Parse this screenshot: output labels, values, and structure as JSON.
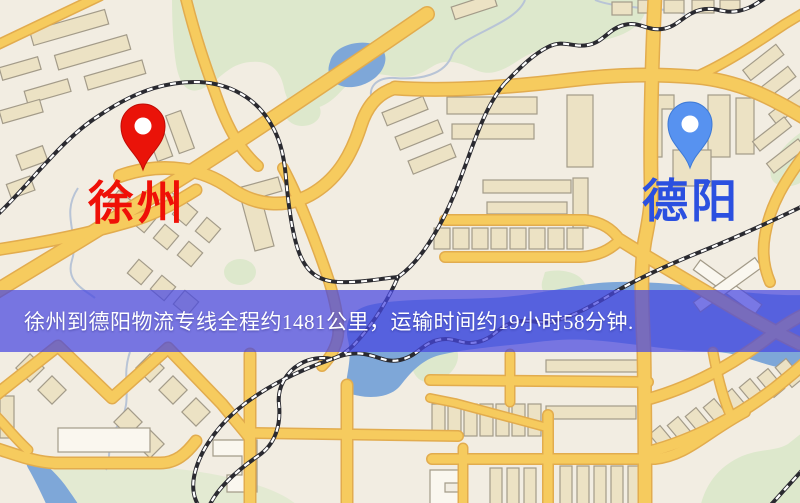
{
  "theme": {
    "map-bg": "#f2ede2",
    "road": "#f6cb5e",
    "road-edge": "#e2ac4e",
    "park": "#dde8cc",
    "water": "#7ea7d8",
    "building": "#ece2c4",
    "building-stroke": "#a39b89",
    "building-white": "#faf7ef",
    "rail-dark": "#2a2a30",
    "stream": "#b8c4d6",
    "banner-bg": "rgba(70,70,224,0.72)",
    "banner-text": "#ffffff"
  },
  "pins": {
    "origin": {
      "label": "徐州",
      "pin_color": "#ea1309",
      "pin_edge": "#c00c06",
      "label_color": "#ef1007"
    },
    "destination": {
      "label": "德阳",
      "pin_color": "#5792f0",
      "pin_edge": "#3e7ad6",
      "label_color": "#2b50e0"
    }
  },
  "banner": {
    "text": "徐州到德阳物流专线全程约1481公里，运输时间约19小时58分钟.",
    "distance_km": "1481",
    "duration": "19小时58分钟"
  }
}
